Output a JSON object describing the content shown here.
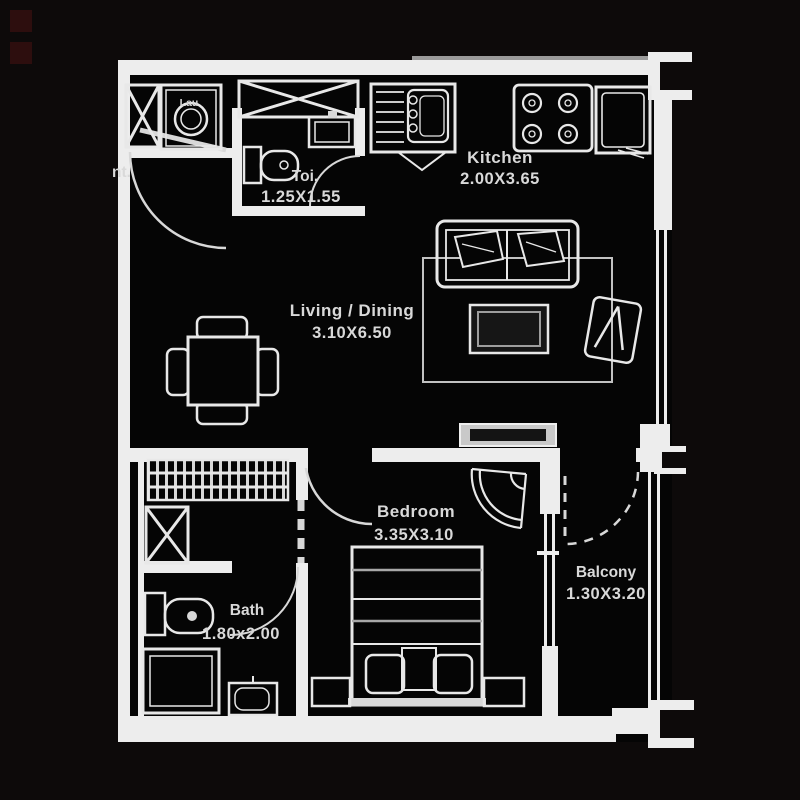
{
  "plan_type": "apartment-floor-plan",
  "colors": {
    "backdrop": "#0d0a0a",
    "floor": "#050505",
    "wall": "#ededed",
    "line": "#e8e8e8",
    "text": "#d9d9d9",
    "accent_squares": "#2d0e0e",
    "console_fill": "#c9c9c9",
    "window_glass": "#9a9a9a"
  },
  "rooms": {
    "kitchen": {
      "name": "Kitchen",
      "dims": "2.00X3.65"
    },
    "living": {
      "name": "Living / Dining",
      "dims": "3.10X6.50"
    },
    "toilet": {
      "name": "Toi.",
      "dims": "1.25X1.55"
    },
    "bedroom": {
      "name": "Bedroom",
      "dims": "3.35X3.10"
    },
    "bath": {
      "name": "Bath",
      "dims": "1.80x2.00"
    },
    "balcony": {
      "name": "Balcony",
      "dims": "1.30X3.20"
    }
  },
  "labels": {
    "entrance_partial": "nt.",
    "laundry": "Lau"
  },
  "icons": {
    "washing-machine-icon": "box with drum circle",
    "shaft-x-icon": "rectangle with X cross",
    "duct-x-icon": "wide rectangle with X cross",
    "wc-toilet-icon": "tank + bowl top view",
    "wash-basin-icon": "rect with inner bowl and tap",
    "kitchen-sink-icon": "drainboard + bowl",
    "stove-icon": "four burner circles",
    "refrigerator-icon": "double rectangle",
    "dining-table-icon": "square table with four chairs",
    "sofa-icon": "three-seat sofa with cushions",
    "coffee-table-icon": "double rectangle",
    "armchair-icon": "tilted chair with N pattern",
    "rug-icon": "thin rectangle outline",
    "tv-console-icon": "gray filled bar",
    "wardrobe-icon": "hatched closet with rails",
    "bed-icon": "bed with blanket bands, pillows, headboard",
    "nightstand-icon": "small rectangle",
    "shower-icon": "double rectangle tray",
    "corner-fan-icon": "fan/shell decor",
    "door-swing-icon": "quarter-circle arc",
    "sliding-door-icon": "dashed line",
    "column-marker-icon": "white C bracket"
  }
}
